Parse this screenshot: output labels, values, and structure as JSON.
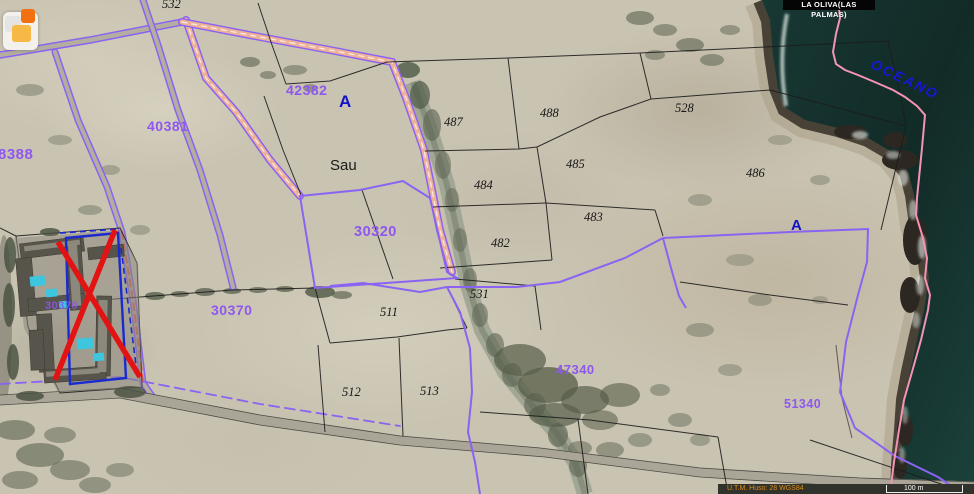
{
  "header": {
    "municipality": "LA OLIVA(LAS PALMAS)"
  },
  "map": {
    "ocean_label": "OCEANO",
    "place_label": "Sau",
    "zone_marker_upper": "A",
    "zone_marker_right": "A"
  },
  "parcels": {
    "black": [
      {
        "id": "532"
      },
      {
        "id": "487"
      },
      {
        "id": "488"
      },
      {
        "id": "528"
      },
      {
        "id": "485"
      },
      {
        "id": "486"
      },
      {
        "id": "484"
      },
      {
        "id": "483"
      },
      {
        "id": "482"
      },
      {
        "id": "531"
      },
      {
        "id": "511"
      },
      {
        "id": "512"
      },
      {
        "id": "513"
      }
    ],
    "purple": [
      {
        "id": "8388"
      },
      {
        "id": "40381"
      },
      {
        "id": "42382"
      },
      {
        "id": "30320"
      },
      {
        "id": "30370"
      },
      {
        "id": "30370"
      },
      {
        "id": "47340"
      },
      {
        "id": "51340"
      }
    ]
  },
  "statusbar": {
    "projection": "U.T.M. Huso: 28 WGS84",
    "scale_label": "100 m"
  },
  "colors": {
    "parcel_line_purple": "#8a63f2",
    "cadastral_label_purple": "#8f57ef",
    "ocean_label_blue": "#1517d8",
    "coastline_pink": "#f493b4",
    "annotation_red": "#e31313",
    "annotation_blue": "#1b2acf",
    "ocean_water": "#16332e"
  }
}
